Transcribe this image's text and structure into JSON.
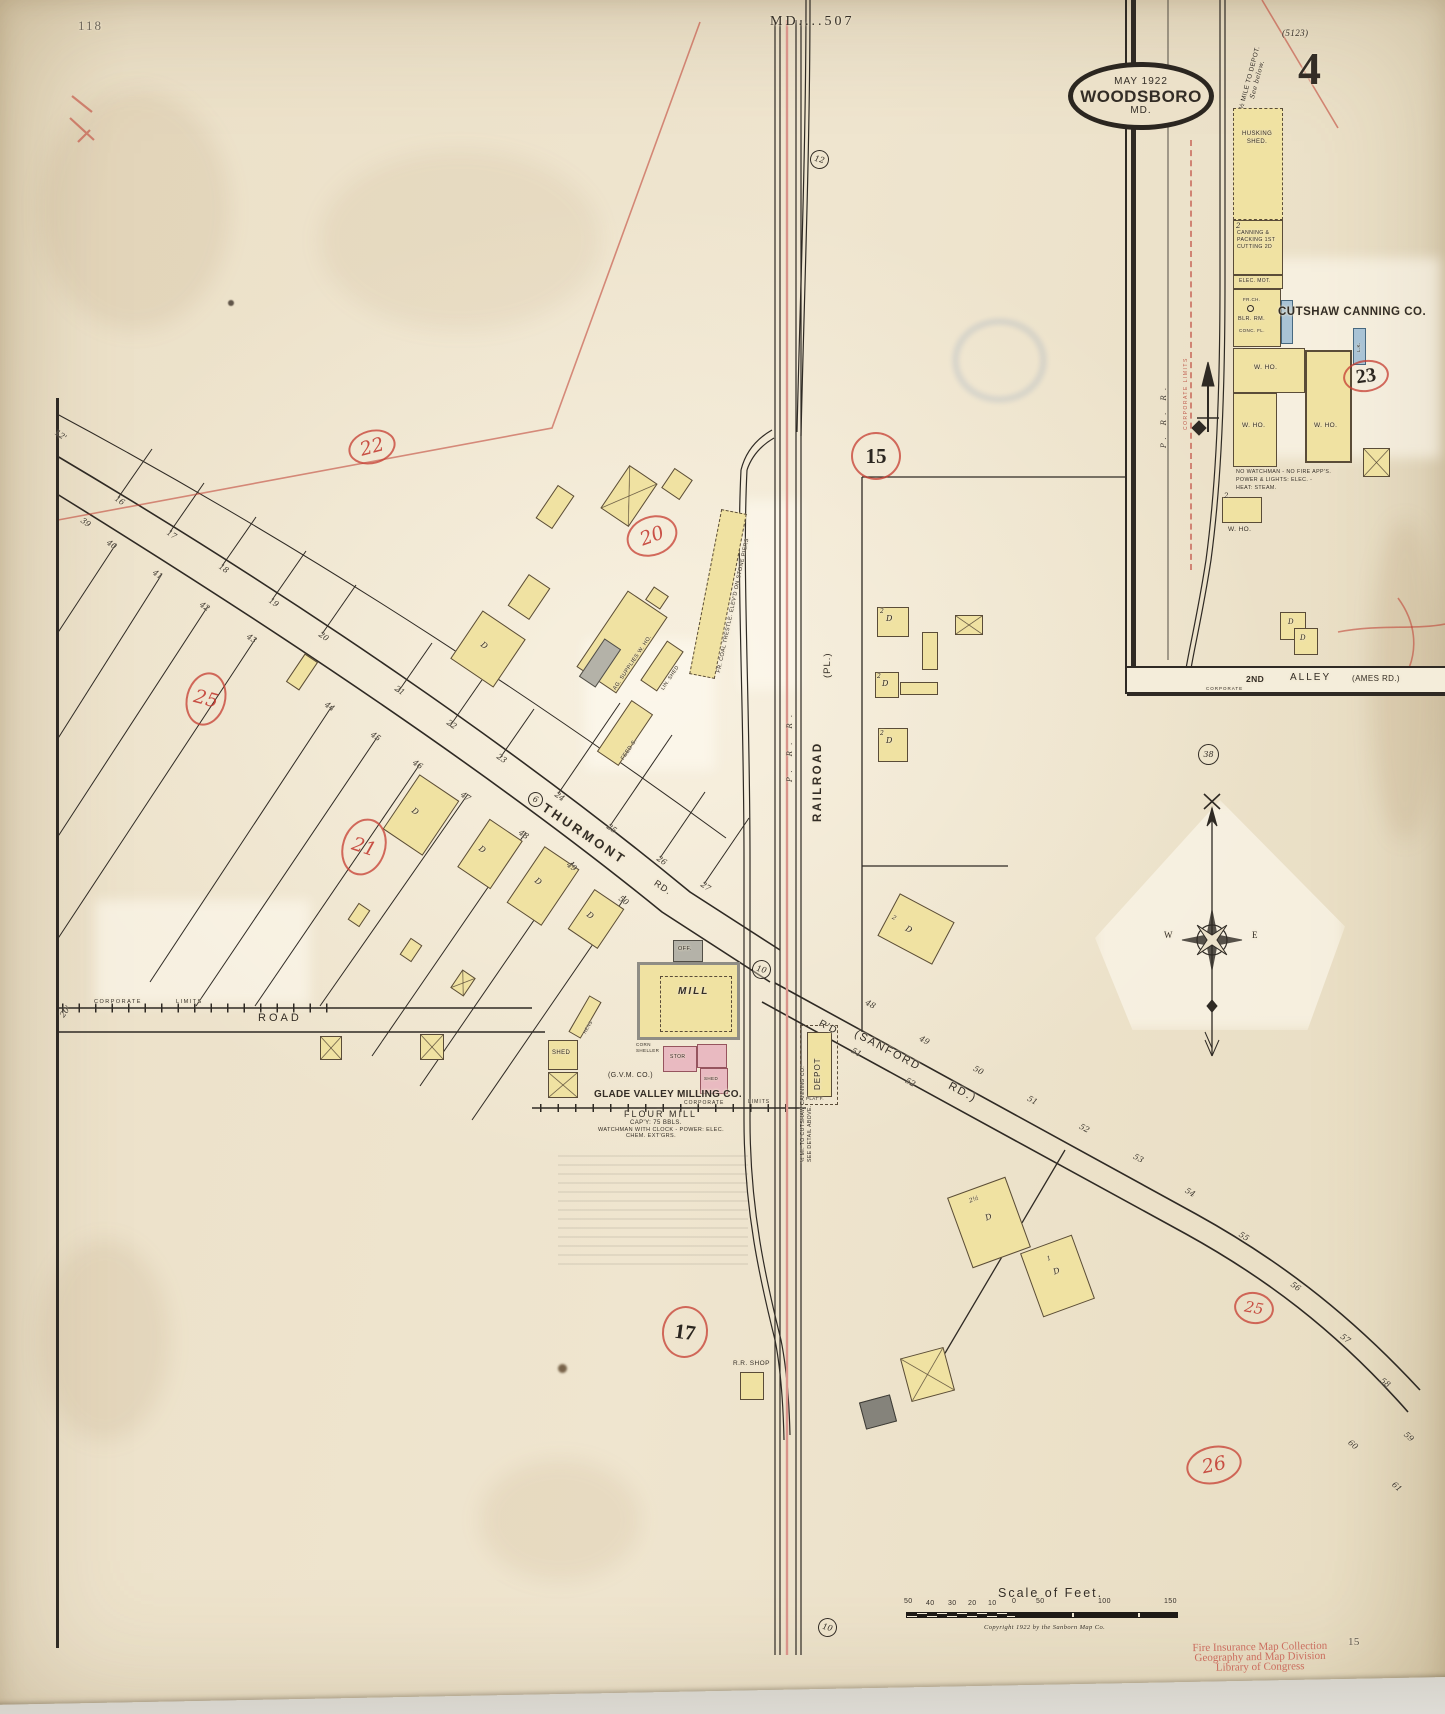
{
  "page": {
    "top_left_number": "118",
    "top_center": "MD....507",
    "plate_ref": "(5123)",
    "sheet_large_number": "4",
    "bottom_right_number": "15"
  },
  "logo": {
    "date": "MAY 1922",
    "name": "WOODSBORO",
    "state": "MD."
  },
  "inset": {
    "depot_note_l1": "½ MILE TO DEPOT.",
    "depot_note_l2": "See below.",
    "husking_l1": "HUSKING",
    "husking_l2": "SHED.",
    "canning_l1": "CANNING &",
    "canning_l2": "PACKING 1ST",
    "canning_l3": "CUTTING 2D",
    "elec_mot": "ELEC. MOT.",
    "fr_ch": "FR.CH.",
    "blr_rm": "BLR. RM.",
    "conc_fl": "CONC. FL.",
    "company": "CUTSHAW CANNING CO.",
    "tank": "L.K.",
    "w_ho": "W. HO.",
    "note_l1": "NO WATCHMAN - NO FIRE APP'S.",
    "note_l2": "POWER & LIGHTS: ELEC. -",
    "note_l3": "HEAT: STEAM.",
    "prr": "P. R. R.",
    "corporate_limits": "CORPORATE LIMITS",
    "alley_no": "2ND",
    "alley": "ALLEY",
    "alley_paren": "(AMES RD.)",
    "corporate": "CORPORATE",
    "ref23": "23",
    "ref38": "38"
  },
  "main": {
    "railroad": "RAILROAD",
    "prr": "P. R. R.",
    "pl": "(PL.)",
    "coal_trestle": "FR. COAL TRESTLE. ELEV'D ON STONE PIERS",
    "thurmont": "THURMONT",
    "thurmont_rd": "RD.",
    "road_circle": "6",
    "road_west": "ROAD",
    "corporate": "CORPORATE",
    "limits": "LIMITS",
    "sanford_rd": "R'D",
    "sanford_paren": "(SANFORD",
    "sanford_paren2": "RD.)",
    "depot": "DEPOT",
    "platf": "PLAT'F.",
    "depot_note_l1": "½ MI. TO CUTSHAW CANNING CO.",
    "depot_note_l2": "SEE DETAIL ABOVE.",
    "rr_shop": "R.R. SHOP",
    "ag_supplies": "AG. SUPPLIES W. HO.",
    "lin_shed": "LIN. SHED",
    "feed_s": "FEED S.",
    "hens": "HENS",
    "shed": "SHED",
    "off": "OFF.",
    "mill": "MILL",
    "corn_l1": "CORN",
    "corn_l2": "SHELLER",
    "stor": "STOR",
    "gvm": "(G.V.M. CO.)",
    "glade": "GLADE VALLEY MILLING CO.",
    "flour": "FLOUR MILL",
    "capy": "CAP'Y: 75 BBLS.",
    "watchman": "WATCHMAN WITH CLOCK - POWER: ELEC.",
    "chem": "CHEM. EXT'GRS.",
    "ref15": "15",
    "ref12": "12",
    "ref10": "10",
    "pencil17": "17",
    "pencil20": "20",
    "pencil21": "21",
    "pencil22": "22",
    "pencil25": "25",
    "pencil26": "26",
    "lot_labels": [
      {
        "t": "16",
        "x": 118,
        "y": 494,
        "r": 34
      },
      {
        "t": "17",
        "x": 170,
        "y": 528,
        "r": 34
      },
      {
        "t": "18",
        "x": 222,
        "y": 562,
        "r": 34
      },
      {
        "t": "19",
        "x": 272,
        "y": 596,
        "r": 34
      },
      {
        "t": "20",
        "x": 322,
        "y": 630,
        "r": 34
      },
      {
        "t": "21",
        "x": 398,
        "y": 684,
        "r": 34
      },
      {
        "t": "22",
        "x": 450,
        "y": 718,
        "r": 34
      },
      {
        "t": "23",
        "x": 500,
        "y": 752,
        "r": 34
      },
      {
        "t": "24",
        "x": 558,
        "y": 790,
        "r": 34
      },
      {
        "t": "25",
        "x": 610,
        "y": 822,
        "r": 34
      },
      {
        "t": "26",
        "x": 660,
        "y": 854,
        "r": 34
      },
      {
        "t": "27",
        "x": 704,
        "y": 880,
        "r": 34
      },
      {
        "t": "39",
        "x": 84,
        "y": 516,
        "r": 34
      },
      {
        "t": "40",
        "x": 110,
        "y": 538,
        "r": 34
      },
      {
        "t": "41",
        "x": 156,
        "y": 568,
        "r": 34
      },
      {
        "t": "42",
        "x": 203,
        "y": 600,
        "r": 34
      },
      {
        "t": "43",
        "x": 250,
        "y": 632,
        "r": 34
      },
      {
        "t": "44",
        "x": 328,
        "y": 700,
        "r": 34
      },
      {
        "t": "45",
        "x": 374,
        "y": 730,
        "r": 34
      },
      {
        "t": "46",
        "x": 416,
        "y": 758,
        "r": 34
      },
      {
        "t": "47",
        "x": 464,
        "y": 790,
        "r": 34
      },
      {
        "t": "48",
        "x": 522,
        "y": 828,
        "r": 34
      },
      {
        "t": "49",
        "x": 570,
        "y": 860,
        "r": 34
      },
      {
        "t": "50",
        "x": 622,
        "y": 894,
        "r": 34
      },
      {
        "t": "12'",
        "x": 58,
        "y": 428,
        "r": 34
      },
      {
        "t": "48",
        "x": 868,
        "y": 998,
        "r": 28
      },
      {
        "t": "49",
        "x": 922,
        "y": 1034,
        "r": 28
      },
      {
        "t": "50",
        "x": 976,
        "y": 1064,
        "r": 28
      },
      {
        "t": "51",
        "x": 1030,
        "y": 1094,
        "r": 28
      },
      {
        "t": "52",
        "x": 1082,
        "y": 1122,
        "r": 28
      },
      {
        "t": "53",
        "x": 1136,
        "y": 1152,
        "r": 28
      },
      {
        "t": "54",
        "x": 1188,
        "y": 1186,
        "r": 30
      },
      {
        "t": "55",
        "x": 1242,
        "y": 1230,
        "r": 32
      },
      {
        "t": "56",
        "x": 1294,
        "y": 1280,
        "r": 34
      },
      {
        "t": "57",
        "x": 1344,
        "y": 1332,
        "r": 36
      },
      {
        "t": "58",
        "x": 1384,
        "y": 1376,
        "r": 38
      },
      {
        "t": "51",
        "x": 854,
        "y": 1046,
        "r": 28
      },
      {
        "t": "52",
        "x": 908,
        "y": 1076,
        "r": 28
      },
      {
        "t": "59",
        "x": 1408,
        "y": 1430,
        "r": 42
      },
      {
        "t": "60",
        "x": 1352,
        "y": 1438,
        "r": 40
      },
      {
        "t": "61",
        "x": 1396,
        "y": 1480,
        "r": 42
      },
      {
        "t": "20'",
        "x": 58,
        "y": 1014,
        "r": -55
      }
    ]
  },
  "compass": {
    "w": "W",
    "e": "E"
  },
  "scale": {
    "title": "Scale of Feet.",
    "left": [
      "50",
      "40",
      "30",
      "20",
      "10",
      "0"
    ],
    "right": [
      "50",
      "100",
      "150"
    ],
    "copyright": "Copyright 1922 by the Sanborn Map Co."
  },
  "stamp": {
    "l1": "Fire Insurance Map Collection",
    "l2": "Geography and Map Division",
    "l3": "Library of Congress"
  },
  "misc": {
    "d": "D",
    "one": "1",
    "two": "2",
    "two_half": "2½"
  }
}
